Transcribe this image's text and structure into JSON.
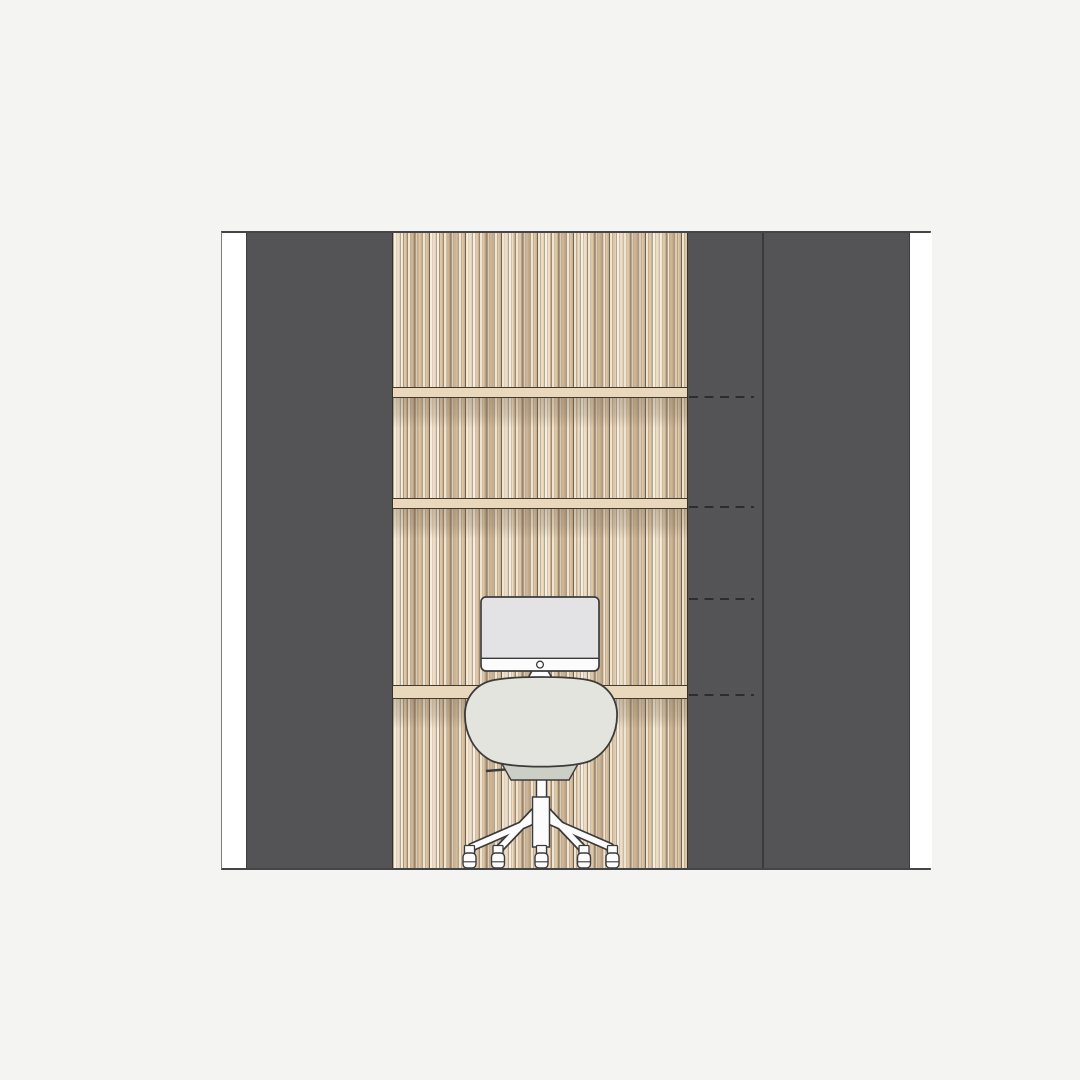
{
  "scene": {
    "description": "Architectural elevation drawing of a workspace niche: dark wall panels flanking a vertical wood-slat wall with two shelves and a desk shelf, a desktop monitor and a swivel task chair",
    "text_content": "none"
  },
  "colors": {
    "bg": "#f4f4f3",
    "dark_panel": "#545356",
    "seam": "#3a3a3d",
    "panel_edge": "#3d3d40",
    "wood_base": "#e7d6ba",
    "wood_edge": "#39322a",
    "shelf_fill": "#e9d8bc",
    "shelf_outline": "#413a2f",
    "dash": "#2c2c2c",
    "outline": "#3b3b3b",
    "white_fill": "#fcfcfd",
    "screen_fill": "#e3e3e5",
    "chair_fill": "#e2e4dd",
    "mech_fill": "#cccfc6"
  },
  "frame": {
    "x": 221,
    "y": 231,
    "width": 710,
    "height": 639
  },
  "columns": [
    {
      "name": "left-white-strip",
      "left": 0,
      "width": 24
    },
    {
      "name": "left-dark-panel",
      "left": 24,
      "width": 146
    },
    {
      "name": "wood-slat-panel",
      "left": 170,
      "width": 296
    },
    {
      "name": "right-dark-panel-inner",
      "left": 466,
      "width": 74
    },
    {
      "name": "panel-seam-line",
      "left": 540,
      "width": 2
    },
    {
      "name": "right-dark-panel-outer",
      "left": 542,
      "width": 146
    },
    {
      "name": "right-white-strip",
      "left": 688,
      "width": 22
    }
  ],
  "shelves": [
    {
      "name": "shelf-upper",
      "top": 154,
      "height": 11
    },
    {
      "name": "shelf-lower",
      "top": 265,
      "height": 11
    },
    {
      "name": "desk-shelf",
      "top": 452,
      "height": 14
    }
  ],
  "dashed_guides": [
    {
      "name": "guide-shelf-upper",
      "top": 163
    },
    {
      "name": "guide-shelf-lower",
      "top": 273
    },
    {
      "name": "guide-monitor-top",
      "top": 365
    },
    {
      "name": "guide-desk",
      "top": 461
    }
  ]
}
